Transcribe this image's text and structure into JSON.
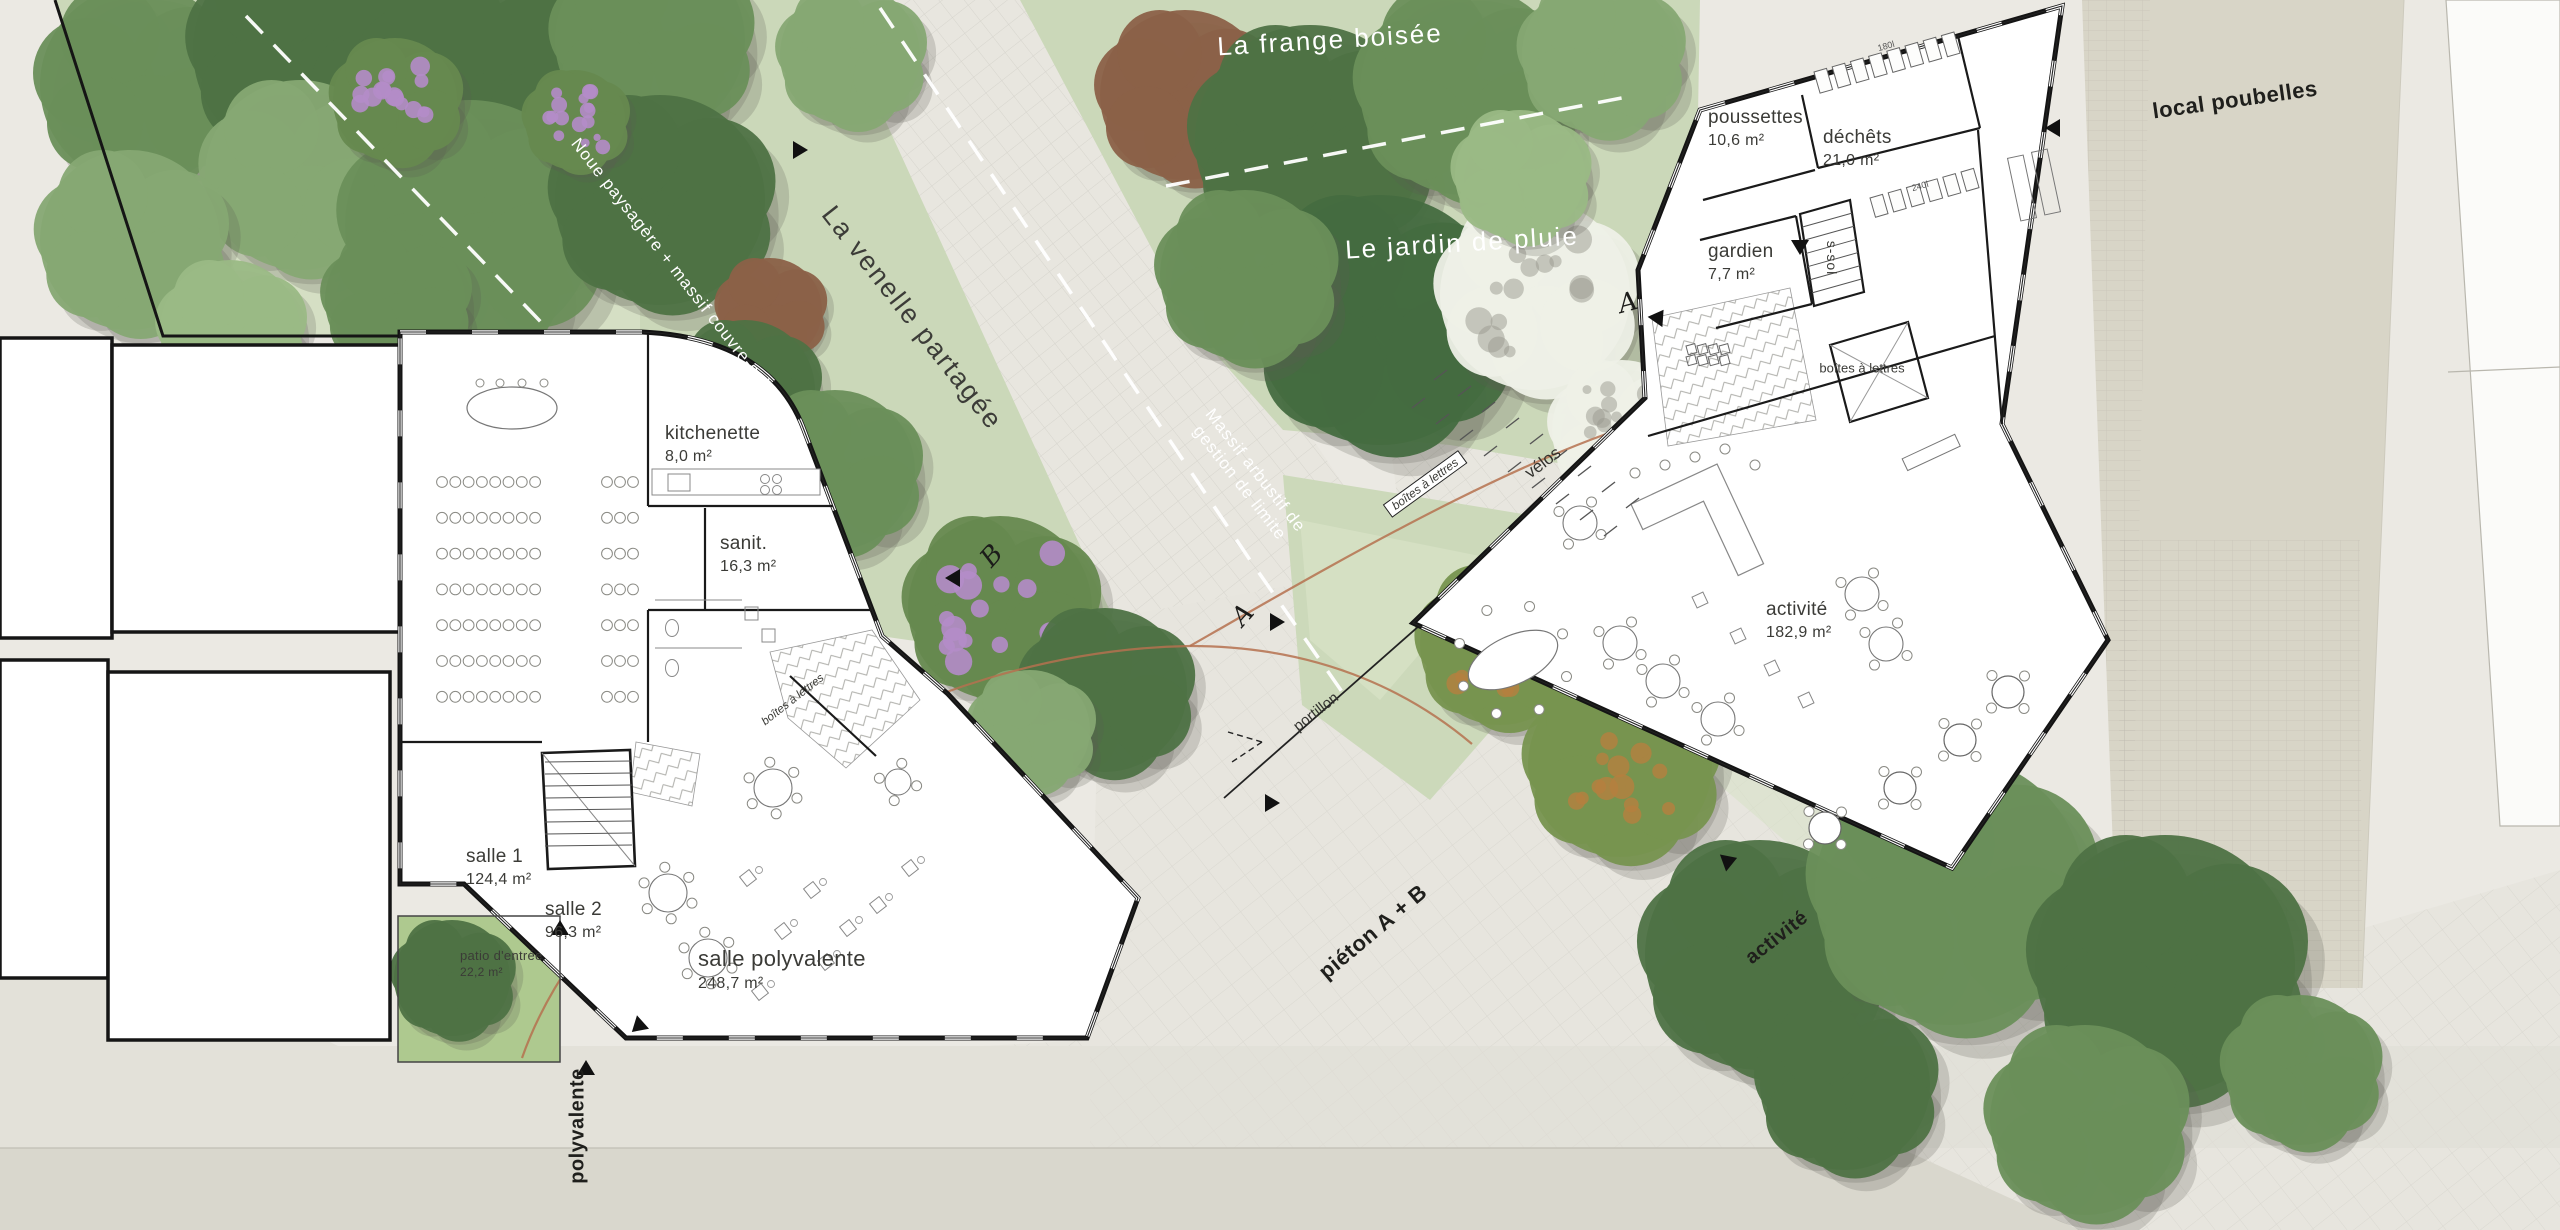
{
  "landscape": {
    "frange": "La frange boisée",
    "jardin": "Le jardin de pluie",
    "venelle": "La venelle partagée",
    "noue": "Noue paysagère + massif couvre-sol",
    "massif": "Massif arbustif de gestion de limite"
  },
  "streets": {
    "local_poubelles": "local poubelles",
    "pieton": "piéton A + B",
    "activite": "activité",
    "polyvalente": "polyvalente"
  },
  "features": {
    "portillon": "portillon",
    "velos": "vélos",
    "boites_bar": "boîtes à lettres",
    "boites_left": "boîtes à lettres",
    "boites_court": "boîtes à lettres",
    "ssol": "s-sol"
  },
  "markers": {
    "a_path": "A",
    "a_entry": "A",
    "b_path": "B"
  },
  "bins": {
    "small": "180l",
    "large": "240l"
  },
  "rooms": {
    "salle1": {
      "name": "salle 1",
      "area": "124,4 m²"
    },
    "salle2": {
      "name": "salle 2",
      "area": "96,3 m²"
    },
    "salle_polyvalente": {
      "name": "salle polyvalente",
      "area": "248,7 m²"
    },
    "kitchenette": {
      "name": "kitchenette",
      "area": "8,0 m²"
    },
    "sanitaires": {
      "name": "sanit.",
      "area": "16,3 m²"
    },
    "patio": {
      "name": "patio d'entrée",
      "area": "22,2 m²"
    },
    "poussettes": {
      "name": "poussettes",
      "area": "10,6 m²"
    },
    "dechets": {
      "name": "déchêts",
      "area": "21,0 m²"
    },
    "gardien": {
      "name": "gardien",
      "area": "7,7 m²"
    },
    "activite": {
      "name": "activité",
      "area": "182,9 m²"
    }
  }
}
